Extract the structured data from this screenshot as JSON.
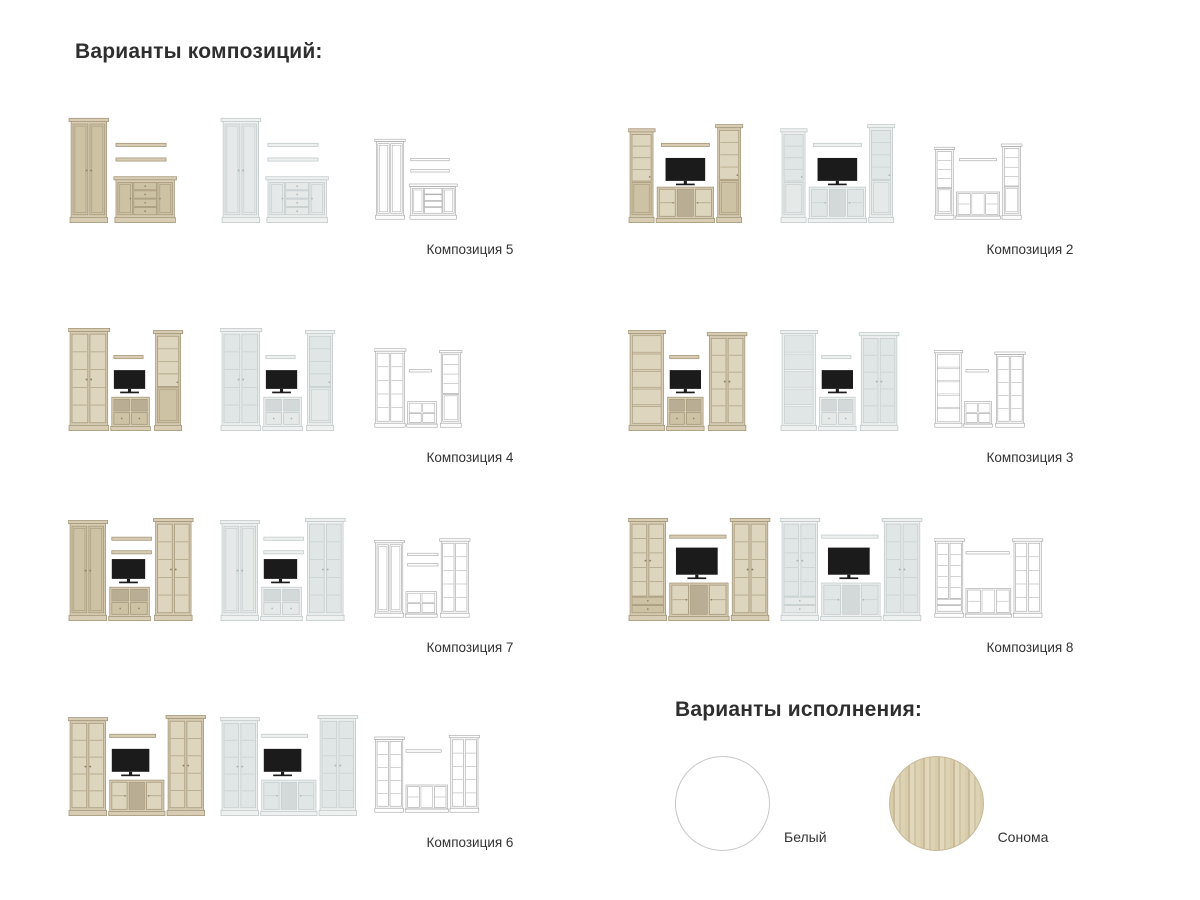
{
  "headings": {
    "compositions": "Варианты композиций:",
    "finishes": "Варианты исполнения:"
  },
  "compositions": [
    {
      "label": "Композиция 5",
      "column": "left",
      "row": 0,
      "pieces": [
        [
          "ward",
          3,
          4,
          34,
          100
        ],
        [
          "shelfh",
          46,
          28,
          48
        ],
        [
          "shelfh",
          46,
          42,
          48
        ],
        [
          "side",
          46,
          60,
          56,
          44
        ]
      ]
    },
    {
      "label": "Композиция 2",
      "column": "right",
      "row": 0,
      "pieces": [
        [
          "ngl",
          2,
          14,
          22,
          90
        ],
        [
          "shelfh",
          32,
          28,
          46
        ],
        [
          "tv",
          36,
          42,
          38,
          22
        ],
        [
          "standg3",
          28,
          70,
          54,
          34
        ],
        [
          "ngl",
          86,
          10,
          22,
          94
        ]
      ]
    },
    {
      "label": "Композиция 4",
      "column": "left",
      "row": 1,
      "pieces": [
        [
          "glass2",
          2,
          6,
          36,
          98
        ],
        [
          "shelfh",
          44,
          32,
          28
        ],
        [
          "tv",
          44,
          46,
          30,
          18
        ],
        [
          "stand2",
          42,
          72,
          36,
          32
        ],
        [
          "ngl",
          84,
          8,
          24,
          96
        ]
      ]
    },
    {
      "label": "Композиция 3",
      "column": "right",
      "row": 1,
      "pieces": [
        [
          "book",
          2,
          8,
          32,
          96
        ],
        [
          "shelfh",
          40,
          32,
          28
        ],
        [
          "tv",
          40,
          46,
          30,
          18
        ],
        [
          "stand2",
          38,
          72,
          34,
          32
        ],
        [
          "glass2",
          78,
          10,
          34,
          94
        ]
      ]
    },
    {
      "label": "Композиция 7",
      "column": "left",
      "row": 2,
      "pieces": [
        [
          "ward",
          2,
          8,
          34,
          96
        ],
        [
          "shelfh",
          42,
          24,
          38
        ],
        [
          "shelfh",
          42,
          37,
          38
        ],
        [
          "tv",
          42,
          45,
          32,
          19
        ],
        [
          "stand2",
          40,
          72,
          38,
          32
        ],
        [
          "glass2",
          84,
          6,
          34,
          98
        ]
      ]
    },
    {
      "label": "Композиция 8",
      "column": "right",
      "row": 2,
      "pieces": [
        [
          "glass2d",
          2,
          6,
          34,
          98
        ],
        [
          "shelfh",
          40,
          22,
          54
        ],
        [
          "tv",
          46,
          34,
          40,
          26
        ],
        [
          "standg3",
          40,
          68,
          56,
          36
        ],
        [
          "glass2",
          100,
          6,
          34,
          98
        ]
      ]
    },
    {
      "label": "Композиция 6",
      "column": "left",
      "row": 3,
      "pieces": [
        [
          "glass2",
          2,
          10,
          34,
          94
        ],
        [
          "shelfh",
          40,
          26,
          44
        ],
        [
          "tv",
          42,
          40,
          36,
          22
        ],
        [
          "standg3",
          40,
          70,
          52,
          34
        ],
        [
          "glass2",
          96,
          8,
          34,
          96
        ]
      ]
    }
  ],
  "render_variants": [
    "sonoma",
    "white",
    "wireframe"
  ],
  "finishes": [
    {
      "label": "Белый",
      "color": "#ffffff"
    },
    {
      "label": "Сонома",
      "color": "#d5c9a9"
    }
  ],
  "palettes": {
    "sonoma": {
      "st": "#a79a7d",
      "body": "#d8cdb4",
      "panel": "#cec2a5",
      "glass": "#ddd5bd",
      "dark": "#b9ae94",
      "tv": "#1b1b1b",
      "handle": "#8d8166"
    },
    "white": {
      "st": "#c4cccc",
      "body": "#eef1f0",
      "panel": "#e5eae9",
      "glass": "#e0e6e6",
      "dark": "#d3d9d9",
      "tv": "#1b1b1b",
      "handle": "#a9b3b3"
    },
    "wire": {
      "st": "#9c9c9c"
    }
  },
  "text_color": "#333333"
}
